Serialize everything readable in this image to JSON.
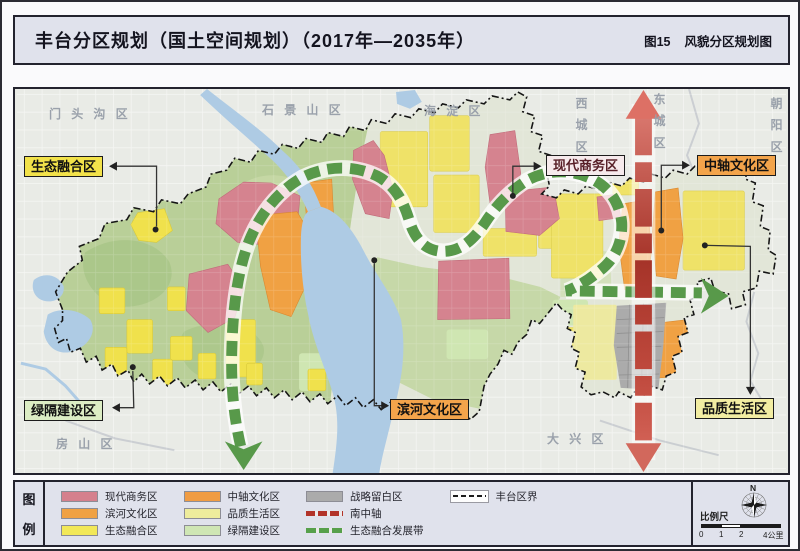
{
  "page": {
    "title": "丰台分区规划（国土空间规划）（2017年—2035年）",
    "figure_label": "图15",
    "figure_title": "风貌分区规划图"
  },
  "map": {
    "districts": [
      {
        "name": "门头沟区"
      },
      {
        "name": "石景山区"
      },
      {
        "name": "海淀区"
      },
      {
        "name": "西城区"
      },
      {
        "name": "东城区"
      },
      {
        "name": "朝阳区"
      },
      {
        "name": "房山区"
      },
      {
        "name": "大兴区"
      }
    ],
    "callouts": [
      {
        "label": "生态融合区"
      },
      {
        "label": "现代商务区"
      },
      {
        "label": "中轴文化区"
      },
      {
        "label": "绿隔建设区"
      },
      {
        "label": "滨河文化区"
      },
      {
        "label": "品质生活区"
      }
    ]
  },
  "legend": {
    "header": [
      "图",
      "例"
    ],
    "area_items": [
      {
        "label": "现代商务区",
        "color": "#d5808d"
      },
      {
        "label": "滨河文化区",
        "color": "#f0a143"
      },
      {
        "label": "生态融合区",
        "color": "#f2e858"
      },
      {
        "label": "中轴文化区",
        "color": "#f09c43"
      },
      {
        "label": "品质生活区",
        "color": "#eeec9c"
      },
      {
        "label": "绿隔建设区",
        "color": "#cfe6b4"
      },
      {
        "label": "战略留白区",
        "color": "#ababab"
      }
    ],
    "line_items": [
      {
        "label": "南中轴",
        "color": "#b23329"
      },
      {
        "label": "生态融合发展带",
        "color": "#57a04b"
      }
    ],
    "boundary_item": {
      "label": "丰台区界"
    },
    "scalebox": {
      "north": "N",
      "scale_label": "比例尺",
      "ticks": [
        "0",
        "1",
        "2",
        "4公里"
      ]
    }
  }
}
